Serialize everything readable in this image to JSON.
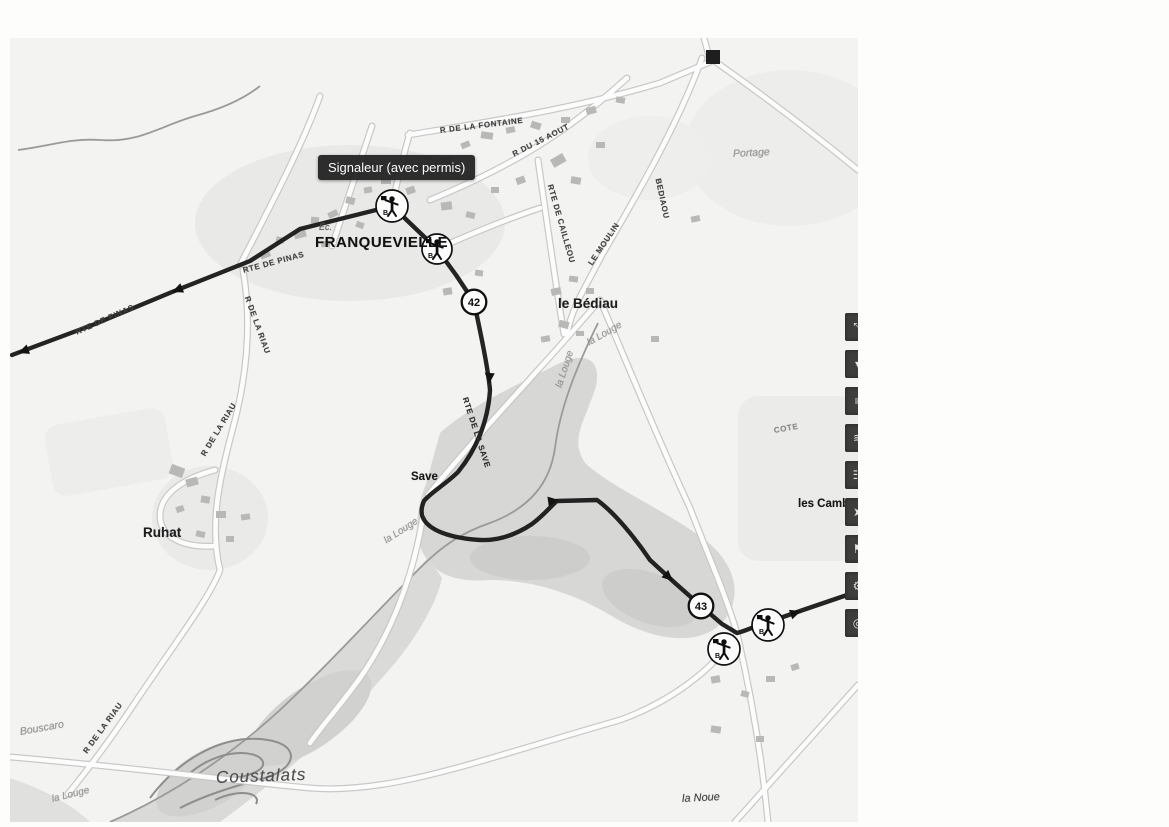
{
  "map": {
    "tooltip": {
      "label": "Signaleur (avec permis)"
    },
    "markers": {
      "signaleurs": [
        {
          "id": "signaleur-1",
          "letter": "B"
        },
        {
          "id": "signaleur-2",
          "letter": "B"
        },
        {
          "id": "signaleur-3",
          "letter": "B"
        },
        {
          "id": "signaleur-4",
          "letter": "B"
        }
      ],
      "km": [
        {
          "label": "42"
        },
        {
          "label": "43"
        }
      ]
    },
    "labels": [
      {
        "text": "FRANQUEVIELLE",
        "x": 305,
        "y": 196,
        "rot": 0,
        "cls": "place-lg"
      },
      {
        "text": "Éc.",
        "x": 309,
        "y": 184,
        "rot": 0,
        "cls": "tiny-it"
      },
      {
        "text": "le Bédiau",
        "x": 548,
        "y": 258,
        "rot": 0,
        "cls": "place-md"
      },
      {
        "text": "Ruhat",
        "x": 133,
        "y": 487,
        "rot": 0,
        "cls": "place-md"
      },
      {
        "text": "Save",
        "x": 401,
        "y": 433,
        "rot": 0,
        "cls": "place-sm"
      },
      {
        "text": "Coustalats",
        "x": 206,
        "y": 730,
        "rot": -2,
        "cls": "place-it-lg"
      },
      {
        "text": "la Noue",
        "x": 672,
        "y": 755,
        "rot": -3,
        "cls": "place-it-sm"
      },
      {
        "text": "Portage",
        "x": 723,
        "y": 110,
        "rot": -3,
        "cls": "place-it-faint"
      },
      {
        "text": "Bouscaro",
        "x": 10,
        "y": 688,
        "rot": -10,
        "cls": "place-it-faint"
      },
      {
        "text": "les Camb",
        "x": 788,
        "y": 460,
        "rot": 0,
        "cls": "place-sm"
      },
      {
        "text": "la Louge",
        "x": 578,
        "y": 300,
        "rot": -30,
        "cls": "water"
      },
      {
        "text": "la Louge",
        "x": 549,
        "y": 344,
        "rot": -72,
        "cls": "water"
      },
      {
        "text": "la Louge",
        "x": 375,
        "y": 498,
        "rot": -33,
        "cls": "water"
      },
      {
        "text": "la Louge",
        "x": 42,
        "y": 756,
        "rot": -14,
        "cls": "water"
      },
      {
        "text": "R DE LA FONTAINE",
        "x": 430,
        "y": 88,
        "rot": -7,
        "cls": "road"
      },
      {
        "text": "R DU 15 AOUT",
        "x": 503,
        "y": 112,
        "rot": -27,
        "cls": "road"
      },
      {
        "text": "RTE DE CAILLEOU",
        "x": 540,
        "y": 142,
        "rot": 74,
        "cls": "road"
      },
      {
        "text": "LE MOULIN",
        "x": 580,
        "y": 222,
        "rot": -56,
        "cls": "road"
      },
      {
        "text": "BEDIAOU",
        "x": 648,
        "y": 136,
        "rot": 78,
        "cls": "road"
      },
      {
        "text": "RTE DE PINAS",
        "x": 66,
        "y": 290,
        "rot": -24,
        "cls": "road"
      },
      {
        "text": "RTE DE PINAS",
        "x": 233,
        "y": 228,
        "rot": -15,
        "cls": "road"
      },
      {
        "text": "R DE LA RIAU",
        "x": 237,
        "y": 254,
        "rot": 70,
        "cls": "road"
      },
      {
        "text": "R DE LA RIAU",
        "x": 193,
        "y": 413,
        "rot": -59,
        "cls": "road"
      },
      {
        "text": "R DE LA RIAU",
        "x": 75,
        "y": 710,
        "rot": -54,
        "cls": "road"
      },
      {
        "text": "RTE DE LA SAVE",
        "x": 455,
        "y": 355,
        "rot": 72,
        "cls": "road-dk"
      },
      {
        "text": "COTE",
        "x": 764,
        "y": 388,
        "rot": -10,
        "cls": "road-faint"
      }
    ],
    "toolbar": {
      "buttons": [
        {
          "name": "move-arrows-button",
          "icon": "diagonal-arrows-icon",
          "glyph": "⤡"
        },
        {
          "name": "marker-button",
          "icon": "marker-icon",
          "glyph": "▾"
        },
        {
          "name": "route-button",
          "icon": "route-icon",
          "glyph": "≡"
        },
        {
          "name": "waves-button",
          "icon": "waves-icon",
          "glyph": "≋"
        },
        {
          "name": "people-button",
          "icon": "people-icon",
          "glyph": "☷"
        },
        {
          "name": "cursor-button",
          "icon": "cursor-icon",
          "glyph": "➤"
        },
        {
          "name": "signaleur-button",
          "icon": "flag-icon",
          "glyph": "⚑"
        },
        {
          "name": "gear-button",
          "icon": "gear-icon",
          "glyph": "⚙"
        },
        {
          "name": "roundabout-button",
          "icon": "roundabout-icon",
          "glyph": "◎"
        }
      ]
    },
    "colors": {
      "route": "#161616",
      "tooltip_bg": "#212121",
      "toolbar_button_bg": "#3d3d3c",
      "map_background": "#f5f5f3",
      "floodplain": "#d9d9d7"
    }
  }
}
